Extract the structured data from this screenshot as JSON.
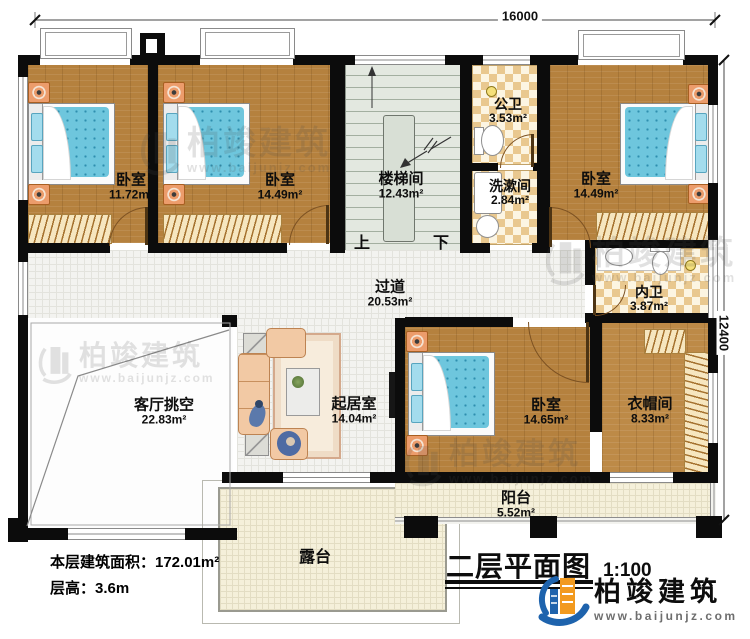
{
  "dimensions": {
    "width_mm": "16000",
    "height_mm": "12400"
  },
  "rooms": [
    {
      "label": "卧室",
      "area": "11.72m²"
    },
    {
      "label": "卧室",
      "area": "14.49m²"
    },
    {
      "label": "楼梯间",
      "area": "12.43m²"
    },
    {
      "label": "公卫",
      "area": "3.53m²"
    },
    {
      "label": "洗漱间",
      "area": "2.84m²"
    },
    {
      "label": "卧室",
      "area": "14.49m²"
    },
    {
      "label": "内卫",
      "area": "3.87m²"
    },
    {
      "label": "过道",
      "area": "20.53m²"
    },
    {
      "label": "客厅挑空",
      "area": "22.83m²"
    },
    {
      "label": "起居室",
      "area": "14.04m²"
    },
    {
      "label": "卧室",
      "area": "14.65m²"
    },
    {
      "label": "衣帽间",
      "area": "8.33m²"
    },
    {
      "label": "阳台",
      "area": "5.52m²"
    },
    {
      "label": "露台",
      "area": ""
    }
  ],
  "stairs": {
    "up": "上",
    "down": "下"
  },
  "footer": {
    "floor_area": "本层建筑面积：172.01m²",
    "floor_height": "层高：3.6m"
  },
  "titleblock": {
    "title": "二层平面图",
    "scale": "1:100"
  },
  "brand": {
    "name": "柏竣建筑",
    "url": "www.baijunjz.com"
  },
  "watermark": {
    "name": "柏竣建筑",
    "url": "www.baijunjz.com"
  },
  "colors": {
    "wall": "#0c0c0c",
    "wood": "#b5813e",
    "checker": "#e9c88f",
    "brand_blue": "#1e63ad",
    "brand_orange": "#f29a1f"
  }
}
